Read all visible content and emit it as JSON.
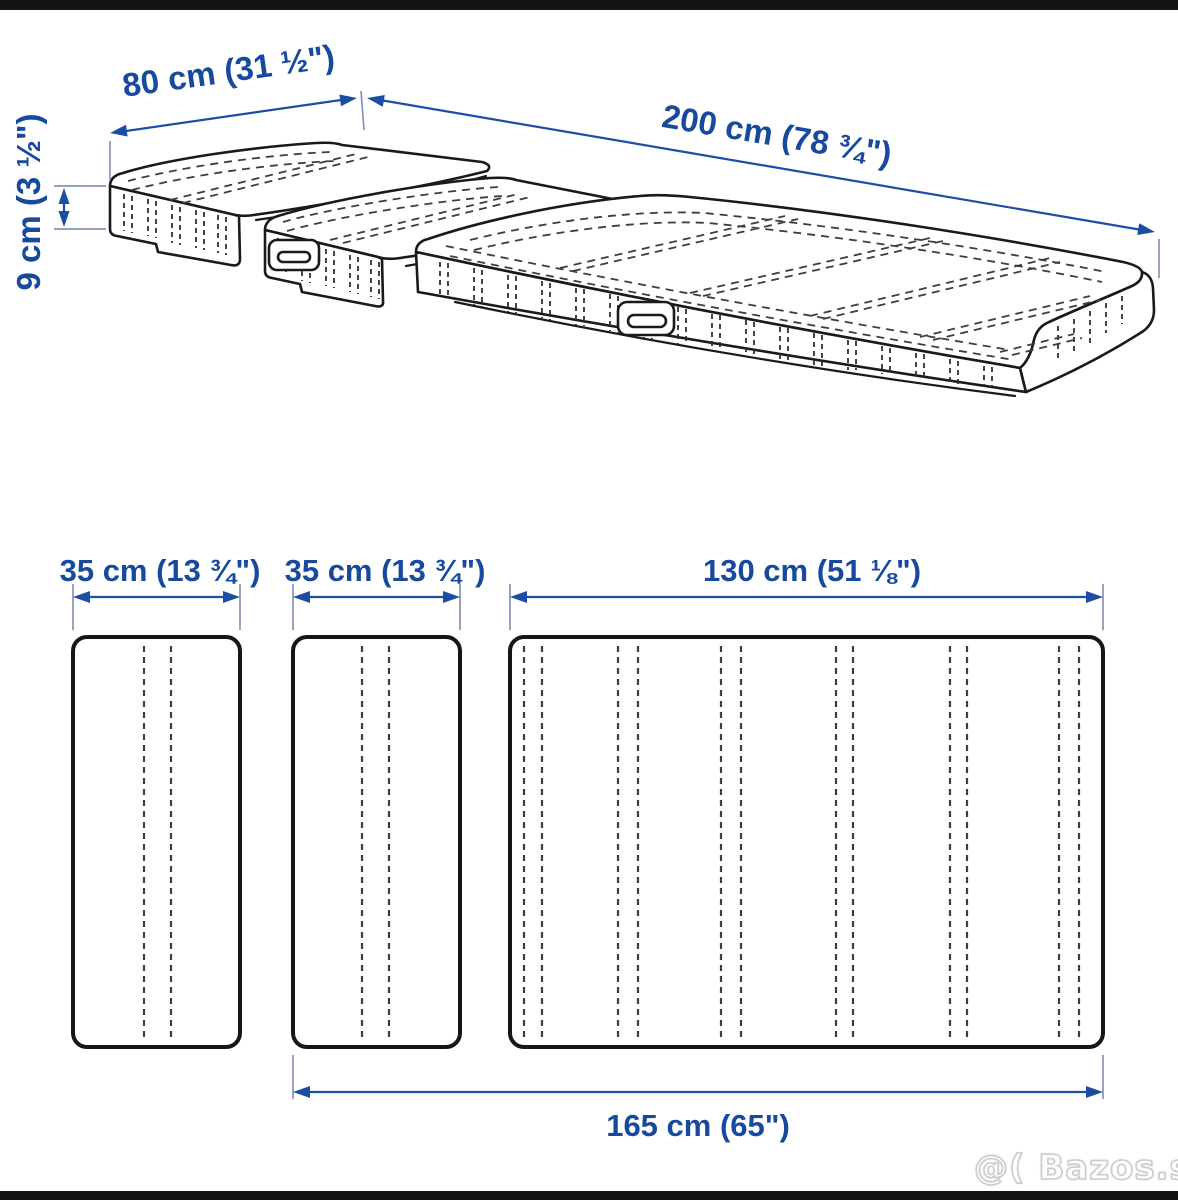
{
  "diagram_title": "mattress-3-section-dimension-diagram",
  "perspective_view": {
    "width_label": "80 cm (31 ½\")",
    "length_label": "200 cm (78 ¾\")",
    "height_label": "9 cm (3 ½\")"
  },
  "plan_view": {
    "section_labels": [
      "35 cm (13 ¾\")",
      "35 cm (13 ¾\")",
      "130 cm (51 ⅛\")"
    ],
    "extended_length_label": "165 cm (65\")"
  },
  "watermark": "@( Bazos.sk",
  "colors": {
    "dimension_text": "#17499e",
    "dimension_arrow": "#1d4ca3",
    "extension_line": "#8893b8",
    "outline_ink": "#1a1a1a",
    "letterbox_bar": "#141414",
    "background": "#ffffff"
  }
}
